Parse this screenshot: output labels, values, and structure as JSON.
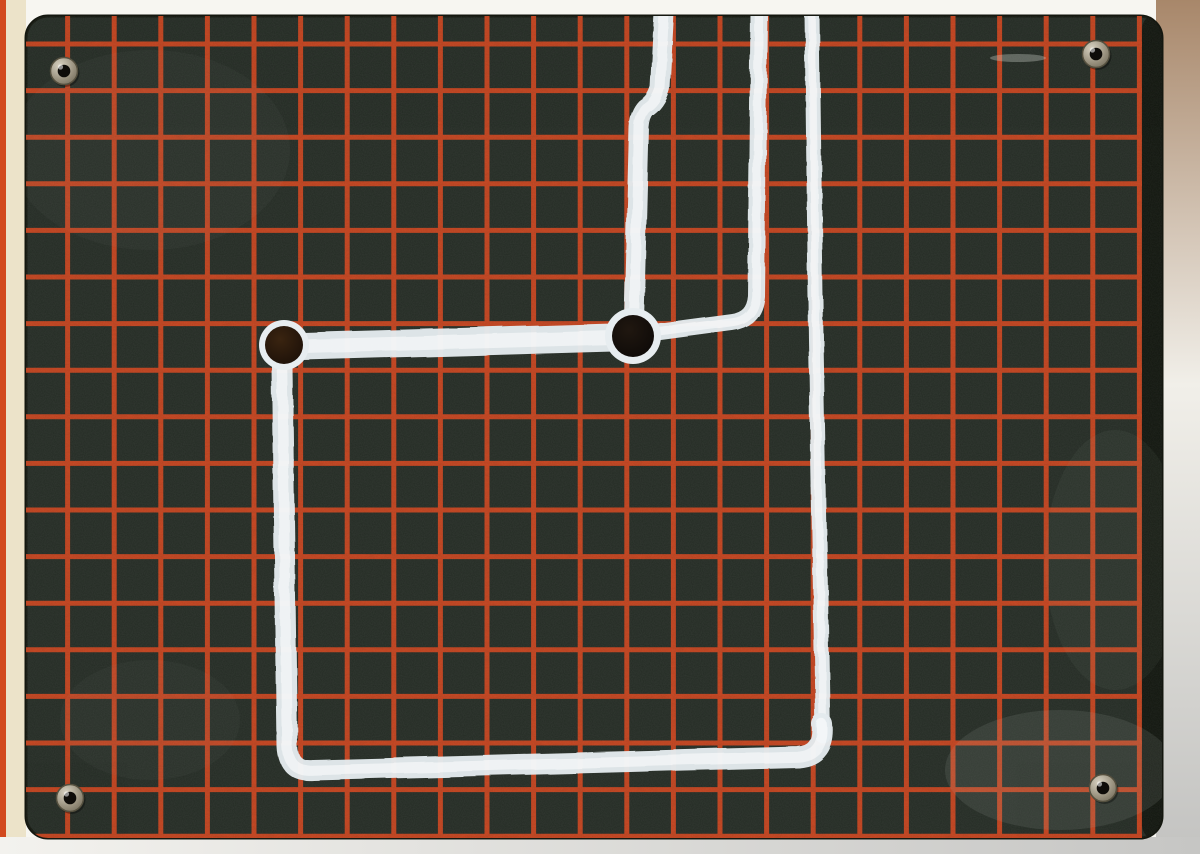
{
  "scene": {
    "description": "scanned photo of a dark board with red grid, white painted circuit traces, two dark pads and four corner grommets",
    "width": 1200,
    "height": 854
  },
  "colors": {
    "scan_bg": "#f7f6f1",
    "left_strip": "#ece3c9",
    "left_edge_stripe": "#d2491d",
    "right_band_top": "#a8876a",
    "right_band_mid": "#f1efe9",
    "right_band_bottom": "#c3c3c1",
    "bottom_band_left": "#f3f2ee",
    "bottom_band_right": "#c6c6c4",
    "board_fill": "#242b24",
    "board_edge": "#14170f",
    "board_rim": "#10140d",
    "grid_red": "#c5421d",
    "paint_base": "#e3eaed",
    "paint_highlight": "#ffffff",
    "pad_halo": "#e7edf0",
    "pad_left_center": "#3a2410",
    "pad_left_edge": "#1a0f08",
    "pad_junction_center": "#201710",
    "pad_junction_edge": "#0c0907",
    "metal_light": "#d8d2c2",
    "metal_mid": "#978f7c",
    "metal_dark": "#6b6555",
    "grommet_hole": "#0e0c09",
    "grommet_stroke": "#55503f"
  },
  "background_layers": [
    {
      "name": "scan-background",
      "x": 0,
      "y": 0,
      "w": 1200,
      "h": 854,
      "fill": "#f7f6f1"
    },
    {
      "name": "left-paper-strip",
      "x": 0,
      "y": 0,
      "w": 26,
      "h": 854,
      "fill": "#ece3c9"
    },
    {
      "name": "left-edge-stripe",
      "x": 0,
      "y": 0,
      "w": 6,
      "h": 854,
      "fill": "#d2491d"
    },
    {
      "name": "right-scan-band",
      "x": 1156,
      "y": 0,
      "w": 44,
      "h": 854,
      "fill": "url(#rightBand)"
    },
    {
      "name": "bottom-scan-band",
      "x": 0,
      "y": 837,
      "w": 1200,
      "h": 17,
      "fill": "url(#bottomBand)"
    }
  ],
  "board": {
    "x": 26,
    "y": 16,
    "width": 1136,
    "height": 822,
    "radius": 22,
    "rim_width": 20
  },
  "grid": {
    "pitch": 46.6,
    "thickness": 5,
    "x0": 21,
    "y0": 44
  },
  "paint_paths": [
    {
      "name": "trace-top-left-vertical",
      "d": "M 664 13 L 660 88 Q 656 102 646 108 Q 640 114 639 127 L 634 320",
      "width": 20
    },
    {
      "name": "trace-top-middle-vertical",
      "d": "M 759 13 L 756 296 Q 754 319 732 322 L 642 334",
      "width": 17
    },
    {
      "name": "trace-horizontal-main",
      "d": "M 286 347 L 631 337",
      "width": 28
    },
    {
      "name": "trace-right-vertical",
      "d": "M 812 13 L 816 340 L 823 736",
      "width": 15
    },
    {
      "name": "trace-rectangle",
      "d": "M 822 724 Q 825 755 798 757 L 313 770 Q 288 772 287 746 L 282 367 Q 281 349 297 348",
      "width": 21
    }
  ],
  "pads": [
    {
      "name": "pad-left",
      "cx": 284,
      "cy": 345,
      "halo_r": 25,
      "r": 19,
      "fill": "url(#leftPad)"
    },
    {
      "name": "pad-junction",
      "cx": 633,
      "cy": 336,
      "halo_r": 28,
      "r": 21,
      "fill": "url(#junctionPad)"
    }
  ],
  "grommets": [
    {
      "name": "grommet-top-left",
      "cx": 64,
      "cy": 71
    },
    {
      "name": "grommet-top-right",
      "cx": 1096,
      "cy": 54
    },
    {
      "name": "grommet-bottom-left",
      "cx": 70,
      "cy": 798
    },
    {
      "name": "grommet-bottom-right",
      "cx": 1103,
      "cy": 788
    }
  ],
  "smudges": [
    {
      "name": "smudge-bottom-right",
      "cx": 1060,
      "cy": 770,
      "rx": 115,
      "ry": 60,
      "fill": "#b8beb4",
      "opacity": 0.12
    },
    {
      "name": "smudge-right-mid",
      "cx": 1115,
      "cy": 560,
      "rx": 70,
      "ry": 130,
      "fill": "#aeb4aa",
      "opacity": 0.06
    },
    {
      "name": "smudge-top-left-sheen",
      "cx": 150,
      "cy": 150,
      "rx": 140,
      "ry": 100,
      "fill": "#9aa096",
      "opacity": 0.05
    },
    {
      "name": "smudge-bottom-left",
      "cx": 150,
      "cy": 720,
      "rx": 90,
      "ry": 60,
      "fill": "#9aa096",
      "opacity": 0.05
    },
    {
      "name": "scratch-marks-top-right",
      "cx": 1018,
      "cy": 58,
      "rx": 28,
      "ry": 4,
      "fill": "#cfd4cc",
      "opacity": 0.35
    }
  ]
}
